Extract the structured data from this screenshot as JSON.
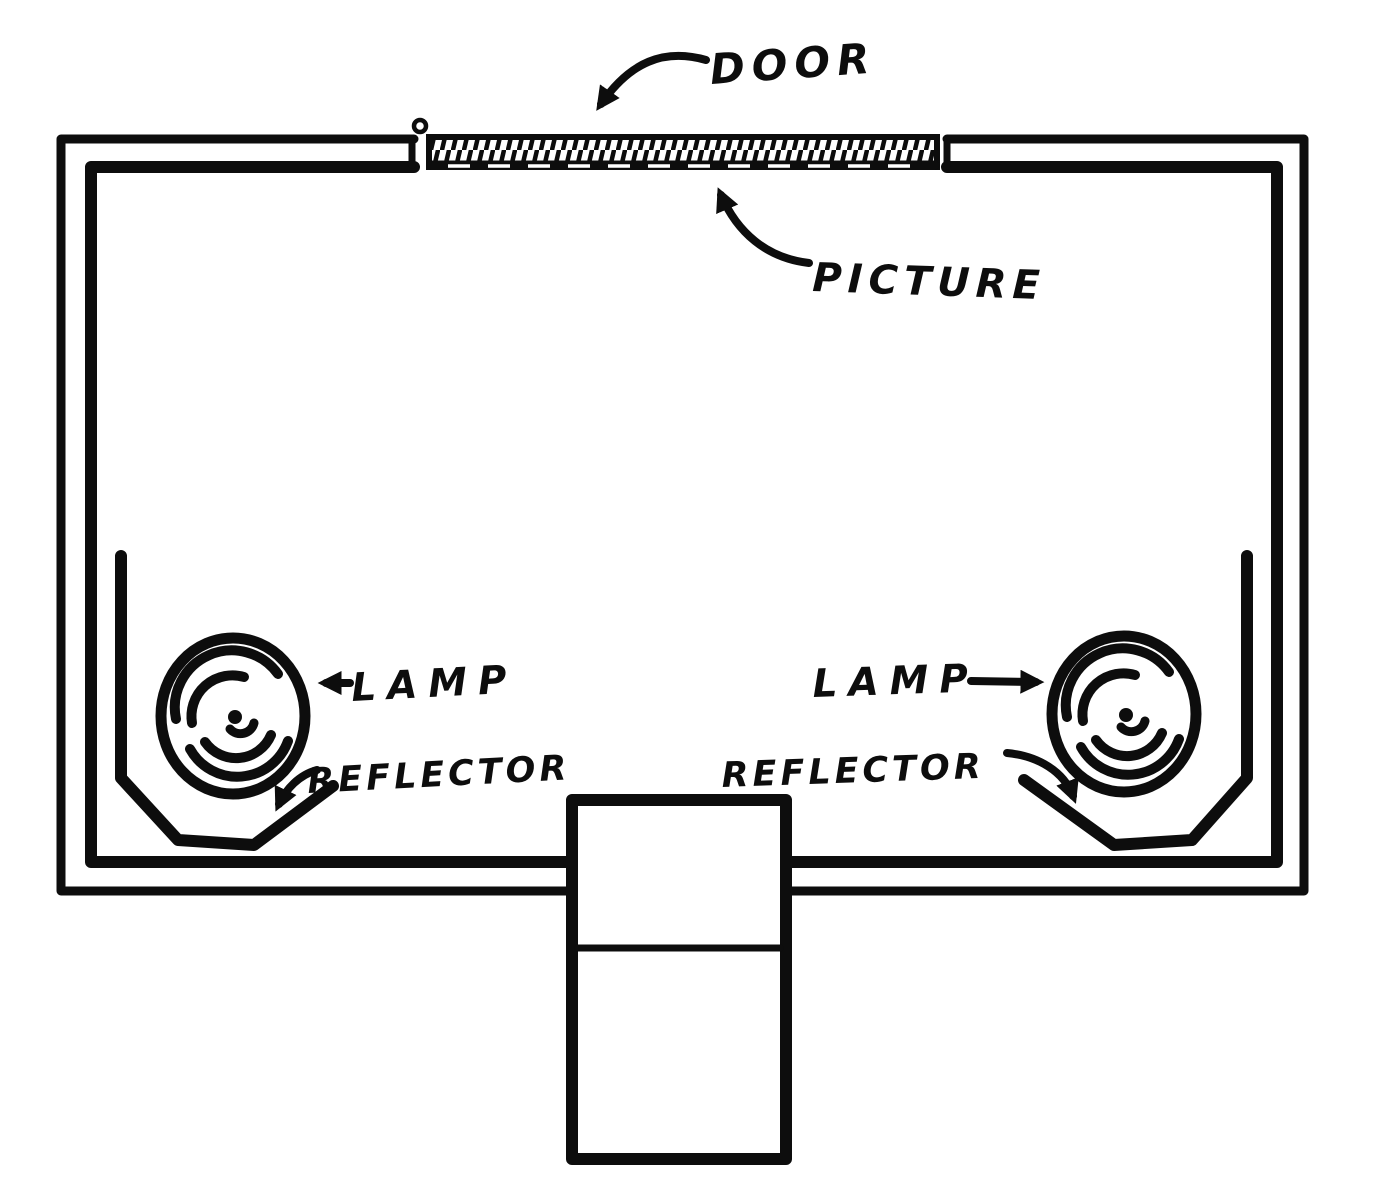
{
  "figure": {
    "title": "Hand-drawn cross-section diagram of an illuminated picture-viewing box",
    "background_color": "#ffffff",
    "ink_color": "#0d0d0d",
    "labels": {
      "door": "DOOR",
      "picture": "PICTURE",
      "lamp_left": "LAMP",
      "lamp_right": "LAMP",
      "reflector_left": "REFLECTOR",
      "reflector_right": "REFLECTOR"
    },
    "parts": {
      "door_slot": "hatched door strip along top wall",
      "hinge": "small hinge knob at left end of door",
      "picture_sheet": "dashed line under door strip",
      "lamps": "two concentric-arc lamp bulbs in lower corners",
      "reflectors": "angled reflector shields around each lamp",
      "eyepiece": "rectangular viewing hood protruding from bottom wall"
    }
  }
}
